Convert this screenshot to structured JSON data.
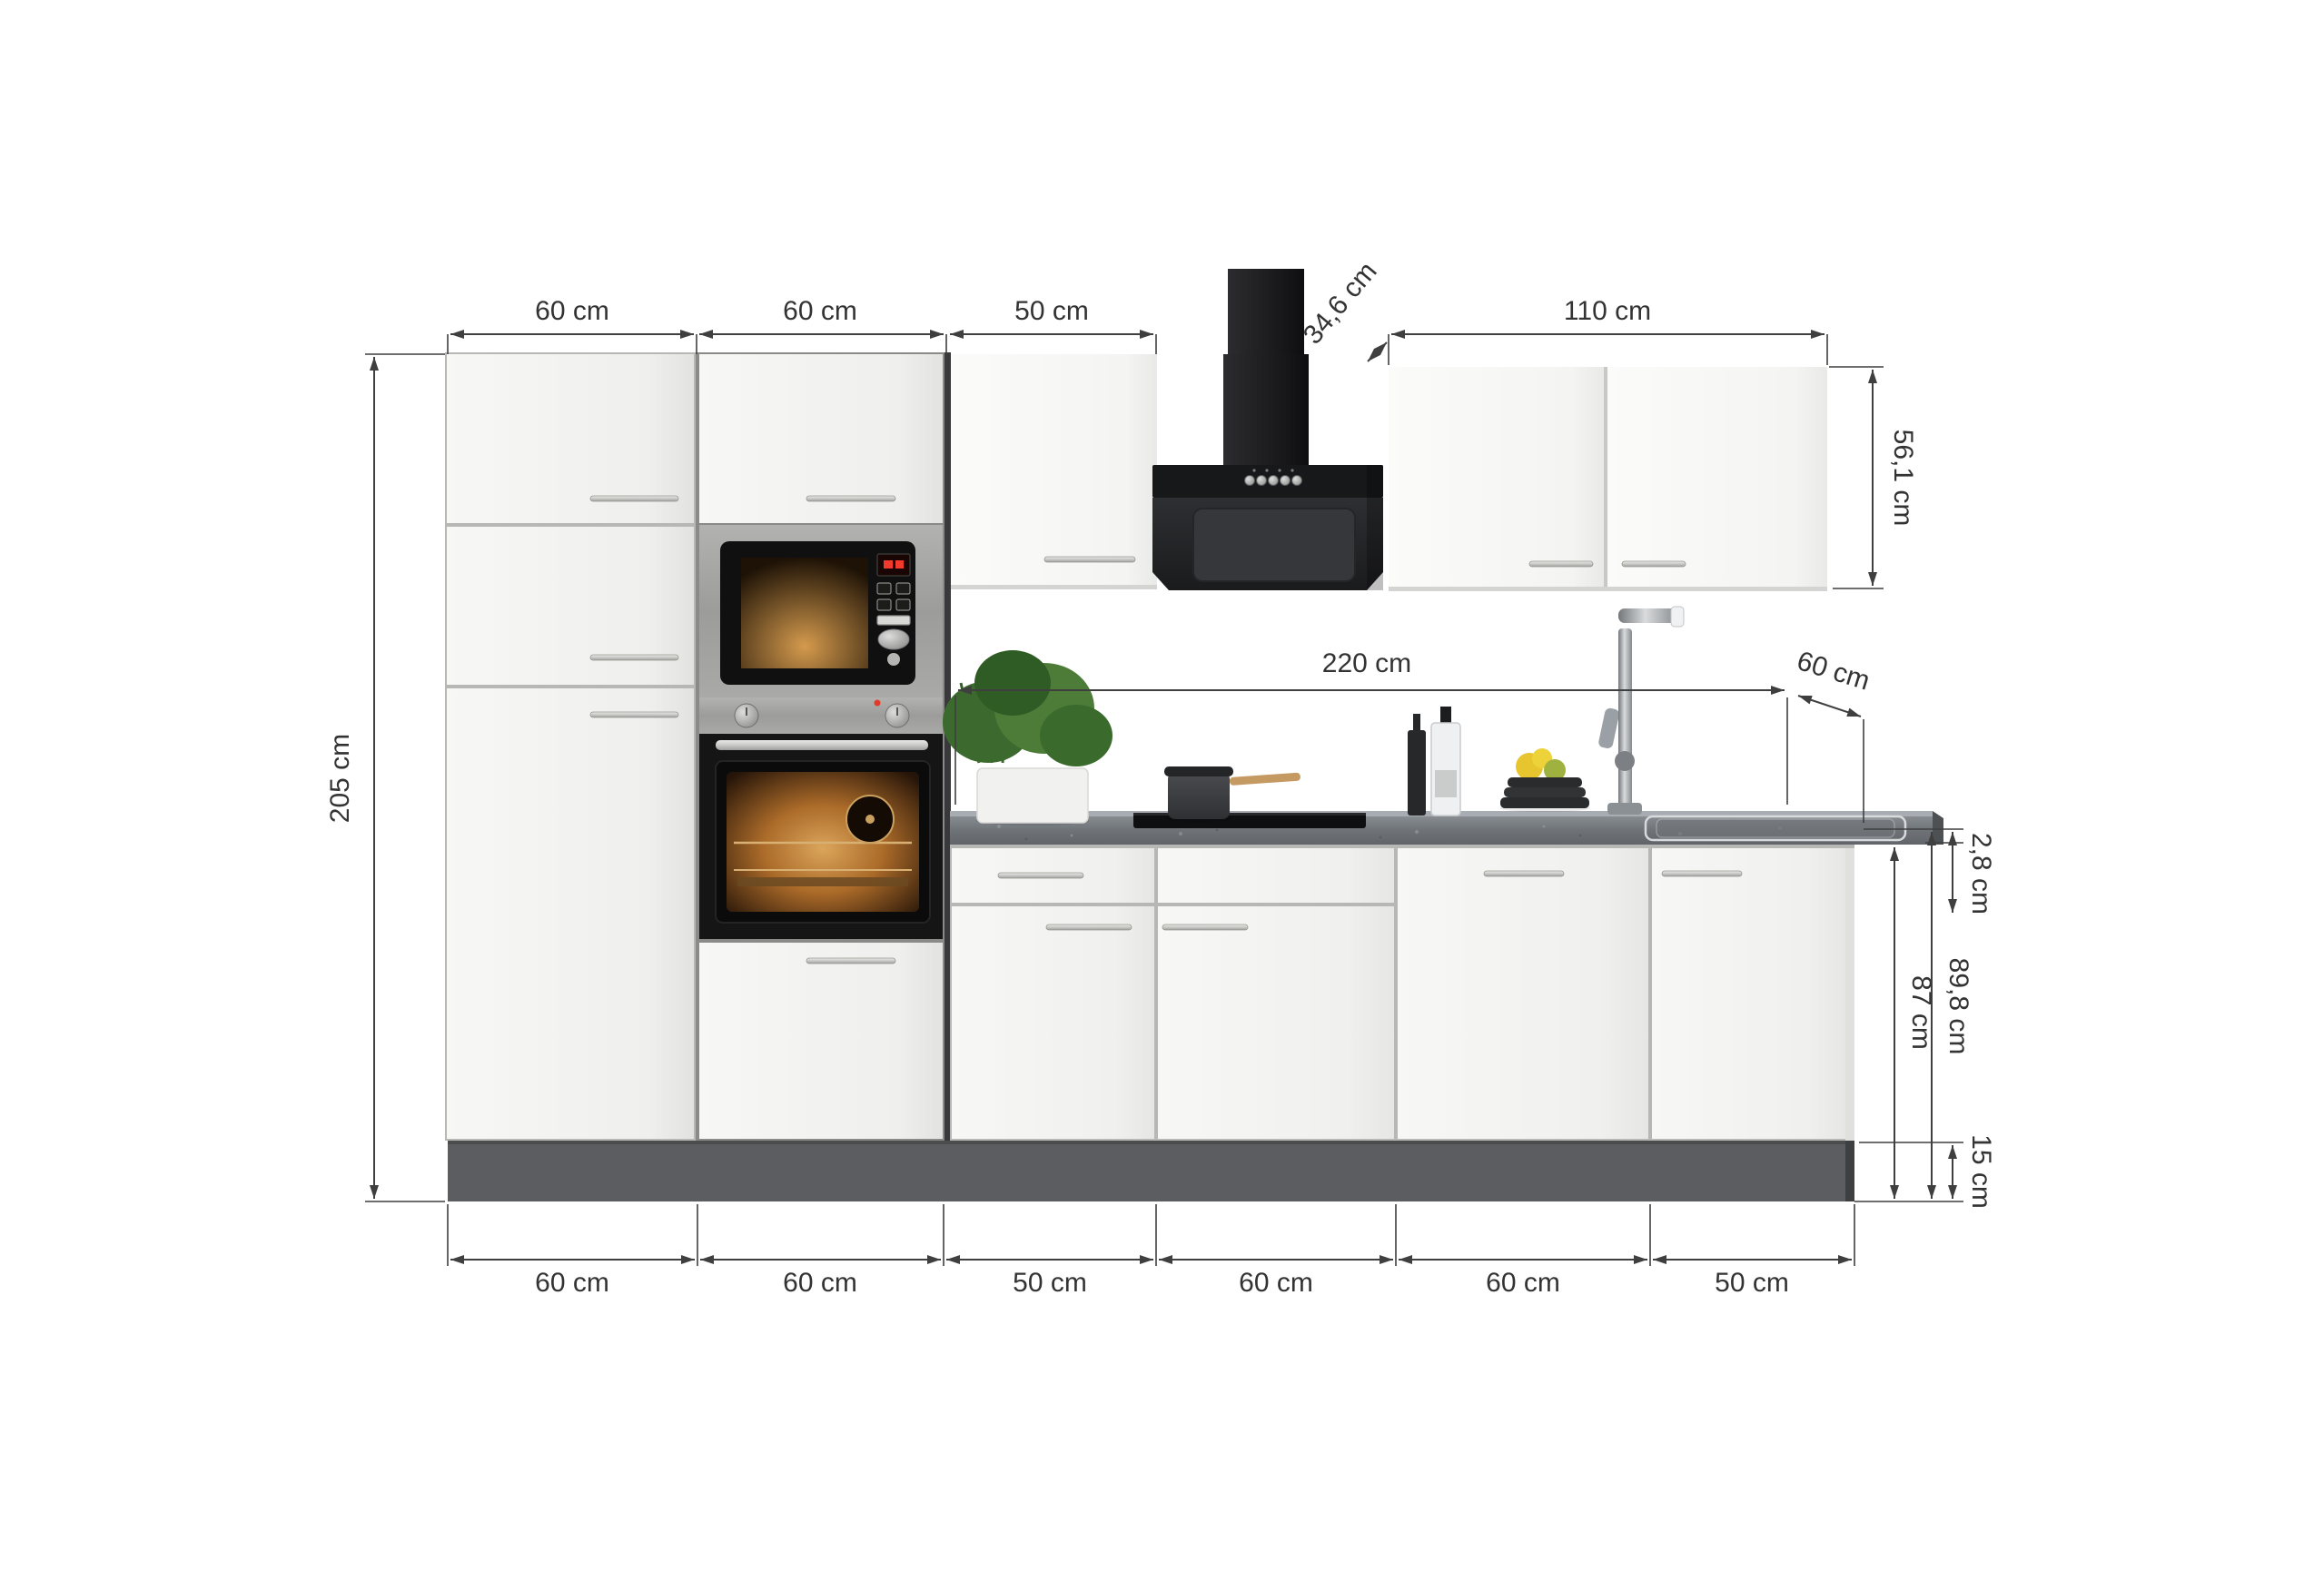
{
  "dims": {
    "top": [
      "60 cm",
      "60 cm",
      "50 cm"
    ],
    "wall_cabinet_depth": "34,6 cm",
    "wall_cabinet_width": "110 cm",
    "wall_cabinet_height": "56,1 cm",
    "worktop_length": "220 cm",
    "worktop_depth": "60 cm",
    "total_height": "205 cm",
    "worktop_thickness": "2,8 cm",
    "base_cabinet_height": "87 cm",
    "worktop_height": "89,8 cm",
    "plinth_height": "15 cm",
    "bottom": [
      "60 cm",
      "60 cm",
      "50 cm",
      "60 cm",
      "60 cm",
      "50 cm"
    ]
  },
  "colors": {
    "background": "#ffffff",
    "dimension_line": "#3f3f3f",
    "dimension_text": "#333333",
    "cabinet_front": "#f6f6f4",
    "plinth": "#5b5d60",
    "worktop": "#6e7378",
    "appliance_black": "#141416",
    "stainless": "#a3a3a1",
    "handle": "#c9c9c7"
  }
}
